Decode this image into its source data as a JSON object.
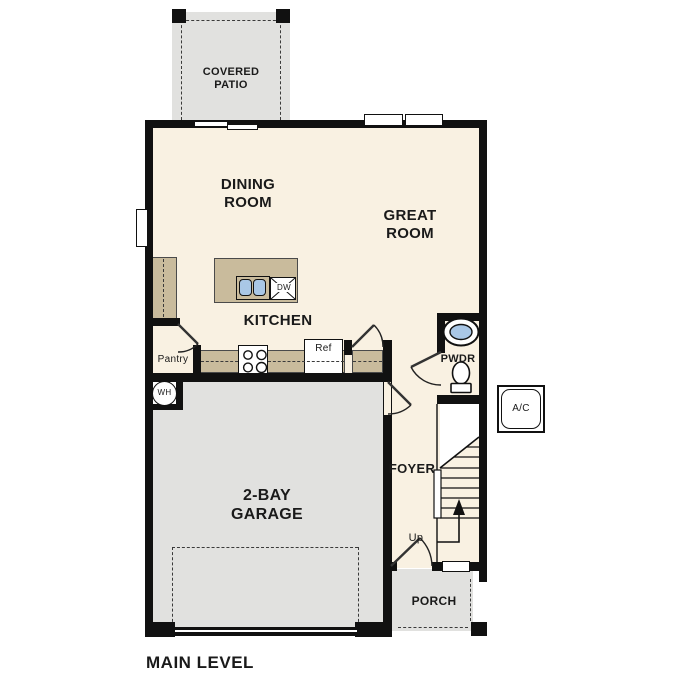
{
  "plan": {
    "title": "MAIN LEVEL",
    "rooms": {
      "covered_patio": {
        "line1": "COVERED",
        "line2": "PATIO"
      },
      "dining_room": {
        "line1": "DINING",
        "line2": "ROOM"
      },
      "great_room": {
        "line1": "GREAT",
        "line2": "ROOM"
      },
      "kitchen": {
        "label": "KITCHEN"
      },
      "pantry": {
        "label": "Pantry"
      },
      "powder_room": {
        "label": "PWDR"
      },
      "foyer": {
        "label": "FOYER"
      },
      "garage": {
        "line1": "2-BAY",
        "line2": "GARAGE"
      },
      "porch": {
        "label": "PORCH"
      },
      "stairs": {
        "direction_label": "Up"
      }
    },
    "fixtures": {
      "refrigerator": {
        "label": "Ref"
      },
      "dishwasher": {
        "label": "DW"
      },
      "water_heater": {
        "label": "WH"
      },
      "ac_unit": {
        "label": "A/C"
      }
    },
    "colors": {
      "floor": "#f9f1e2",
      "slab": "#e1e1df",
      "counter": "#c9bb9c",
      "wall": "#111111",
      "sink_blue": "#a9c7e6"
    }
  }
}
